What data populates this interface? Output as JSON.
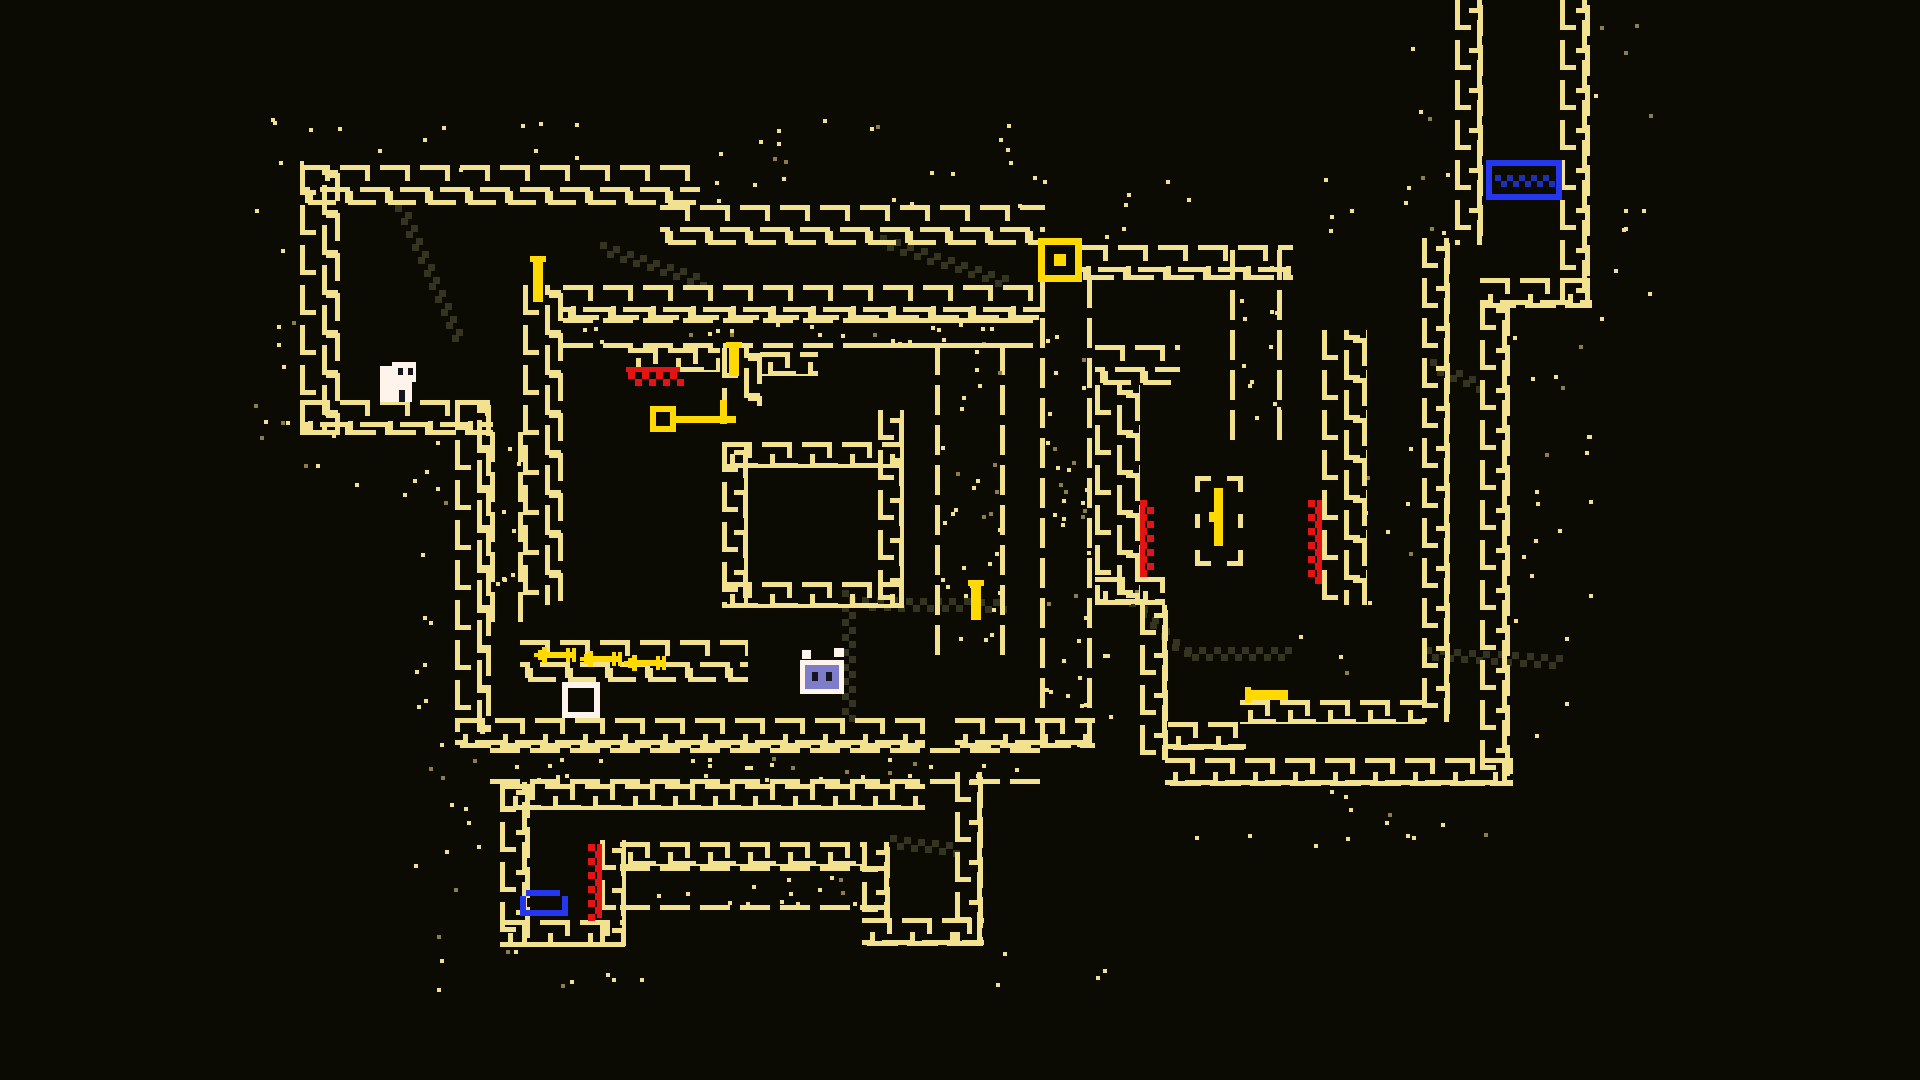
{
  "scene": {
    "width": 1920,
    "height": 1080,
    "bg": "#0b0b03"
  },
  "colors": {
    "wall": "#f2e28f",
    "bright": "#ffd900",
    "red": "#e51414",
    "blue": "#2437ef",
    "bedfill": "#1e2fb8",
    "slime": "#7d7dc9",
    "white": "#fff4ec",
    "dark": "#16161e",
    "trail": "#343420",
    "dim": "#8a7f4a"
  },
  "walls": [
    {
      "x": 300,
      "y": 165,
      "w": 400,
      "h": 40,
      "style": "brick"
    },
    {
      "x": 660,
      "y": 205,
      "w": 385,
      "h": 40,
      "style": "brick"
    },
    {
      "x": 1078,
      "y": 245,
      "w": 215,
      "h": 35,
      "style": "brick"
    },
    {
      "x": 300,
      "y": 165,
      "w": 40,
      "h": 270,
      "style": "brick"
    },
    {
      "x": 300,
      "y": 400,
      "w": 193,
      "h": 35,
      "style": "brick"
    },
    {
      "x": 455,
      "y": 400,
      "w": 36,
      "h": 332,
      "style": "brick"
    },
    {
      "x": 490,
      "y": 432,
      "w": 33,
      "h": 173,
      "style": "dots"
    },
    {
      "x": 523,
      "y": 285,
      "w": 40,
      "h": 320,
      "style": "brick"
    },
    {
      "x": 563,
      "y": 285,
      "w": 482,
      "h": 35,
      "style": "brick"
    },
    {
      "x": 563,
      "y": 318,
      "w": 445,
      "h": 30,
      "style": "dots"
    },
    {
      "x": 628,
      "y": 348,
      "w": 92,
      "h": 24,
      "style": "brick"
    },
    {
      "x": 722,
      "y": 348,
      "w": 40,
      "h": 58,
      "style": "brick"
    },
    {
      "x": 760,
      "y": 352,
      "w": 58,
      "h": 24,
      "style": "brick"
    },
    {
      "x": 722,
      "y": 442,
      "w": 182,
      "h": 26,
      "style": "brick"
    },
    {
      "x": 722,
      "y": 442,
      "w": 26,
      "h": 166,
      "style": "brick"
    },
    {
      "x": 878,
      "y": 410,
      "w": 26,
      "h": 198,
      "style": "brick"
    },
    {
      "x": 722,
      "y": 582,
      "w": 182,
      "h": 26,
      "style": "brick"
    },
    {
      "x": 935,
      "y": 345,
      "w": 70,
      "h": 300,
      "style": "dots"
    },
    {
      "x": 860,
      "y": 318,
      "w": 148,
      "h": 30,
      "style": "dots"
    },
    {
      "x": 1040,
      "y": 278,
      "w": 52,
      "h": 442,
      "style": "dots"
    },
    {
      "x": 455,
      "y": 718,
      "w": 470,
      "h": 30,
      "style": "brick"
    },
    {
      "x": 955,
      "y": 718,
      "w": 140,
      "h": 30,
      "style": "brick"
    },
    {
      "x": 490,
      "y": 748,
      "w": 555,
      "h": 36,
      "style": "dots"
    },
    {
      "x": 505,
      "y": 784,
      "w": 420,
      "h": 26,
      "style": "brick"
    },
    {
      "x": 520,
      "y": 640,
      "w": 228,
      "h": 42,
      "style": "brick"
    },
    {
      "x": 500,
      "y": 782,
      "w": 30,
      "h": 165,
      "style": "brick"
    },
    {
      "x": 500,
      "y": 920,
      "w": 125,
      "h": 27,
      "style": "brick"
    },
    {
      "x": 600,
      "y": 840,
      "w": 26,
      "h": 106,
      "style": "brick"
    },
    {
      "x": 620,
      "y": 842,
      "w": 244,
      "h": 24,
      "style": "brick"
    },
    {
      "x": 620,
      "y": 866,
      "w": 244,
      "h": 44,
      "style": "dots"
    },
    {
      "x": 862,
      "y": 842,
      "w": 28,
      "h": 78,
      "style": "brick"
    },
    {
      "x": 862,
      "y": 918,
      "w": 122,
      "h": 28,
      "style": "brick"
    },
    {
      "x": 955,
      "y": 772,
      "w": 28,
      "h": 174,
      "style": "brick"
    },
    {
      "x": 1095,
      "y": 345,
      "w": 85,
      "h": 40,
      "style": "brick"
    },
    {
      "x": 1230,
      "y": 250,
      "w": 52,
      "h": 172,
      "style": "dots"
    },
    {
      "x": 1095,
      "y": 385,
      "w": 45,
      "h": 220,
      "style": "brick"
    },
    {
      "x": 1322,
      "y": 330,
      "w": 45,
      "h": 275,
      "style": "brick"
    },
    {
      "x": 1095,
      "y": 577,
      "w": 70,
      "h": 28,
      "style": "brick"
    },
    {
      "x": 1140,
      "y": 605,
      "w": 28,
      "h": 155,
      "style": "brick"
    },
    {
      "x": 1168,
      "y": 722,
      "w": 78,
      "h": 28,
      "style": "brick"
    },
    {
      "x": 1240,
      "y": 700,
      "w": 185,
      "h": 24,
      "style": "brick"
    },
    {
      "x": 1165,
      "y": 758,
      "w": 348,
      "h": 28,
      "style": "brick"
    },
    {
      "x": 1422,
      "y": 238,
      "w": 28,
      "h": 484,
      "style": "brick"
    },
    {
      "x": 1455,
      "y": 0,
      "w": 28,
      "h": 245,
      "style": "brick"
    },
    {
      "x": 1560,
      "y": 0,
      "w": 30,
      "h": 305,
      "style": "brick"
    },
    {
      "x": 1480,
      "y": 278,
      "w": 112,
      "h": 30,
      "style": "brick"
    },
    {
      "x": 1480,
      "y": 300,
      "w": 30,
      "h": 486,
      "style": "brick"
    }
  ],
  "dotfields": [
    [
      240,
      118,
      830,
      55
    ],
    [
      242,
      182,
      62,
      255
    ],
    [
      240,
      432,
      225,
      55
    ],
    [
      398,
      455,
      60,
      270
    ],
    [
      412,
      742,
      92,
      215
    ],
    [
      432,
      942,
      250,
      55
    ],
    [
      988,
      942,
      120,
      50
    ],
    [
      1062,
      172,
      125,
      75
    ],
    [
      1300,
      172,
      135,
      68
    ],
    [
      1592,
      2,
      58,
      315
    ],
    [
      1408,
      0,
      50,
      240
    ],
    [
      1512,
      308,
      85,
      95
    ],
    [
      1348,
      438,
      72,
      165
    ],
    [
      1512,
      432,
      78,
      325
    ],
    [
      1168,
      790,
      348,
      58
    ],
    [
      1062,
      580,
      80,
      165
    ],
    [
      700,
      162,
      355,
      45
    ],
    [
      1288,
      610,
      58,
      95
    ]
  ],
  "trails": [
    [
      398,
      205,
      455,
      335
    ],
    [
      600,
      245,
      700,
      278
    ],
    [
      880,
      238,
      1002,
      278
    ],
    [
      845,
      590,
      845,
      715
    ],
    [
      862,
      600,
      1000,
      602
    ],
    [
      890,
      838,
      953,
      846
    ],
    [
      1132,
      600,
      1180,
      650
    ],
    [
      1185,
      650,
      1285,
      650
    ],
    [
      1425,
      650,
      1556,
      658
    ],
    [
      1430,
      362,
      1476,
      382
    ]
  ],
  "spikes": [
    {
      "x": 588,
      "y": 844,
      "len": 74,
      "dir": "v",
      "side": "right"
    },
    {
      "x": 1140,
      "y": 500,
      "len": 77,
      "dir": "v",
      "side": "left"
    },
    {
      "x": 1308,
      "y": 500,
      "len": 84,
      "dir": "v",
      "side": "right"
    },
    {
      "x": 628,
      "y": 372,
      "len": 50,
      "dir": "h",
      "side": "top"
    }
  ],
  "arrows": [
    [
      534,
      646
    ],
    [
      580,
      650
    ],
    [
      624,
      654
    ]
  ],
  "levers": [
    {
      "x": 533,
      "y": 256,
      "w": 10,
      "h": 46,
      "dir": "v"
    },
    {
      "x": 729,
      "y": 342,
      "w": 10,
      "h": 34,
      "dir": "v"
    },
    {
      "x": 971,
      "y": 580,
      "w": 10,
      "h": 40,
      "dir": "v"
    },
    {
      "x": 1248,
      "y": 690,
      "w": 40,
      "h": 10,
      "dir": "h"
    }
  ],
  "entities": {
    "player": {
      "label": "player-character",
      "x": 378,
      "y": 356,
      "w": 42,
      "h": 48
    },
    "key": {
      "label": "key-item",
      "x": 650,
      "y": 400,
      "w": 92,
      "h": 38
    },
    "door": {
      "label": "exit-door",
      "x": 1038,
      "y": 238,
      "w": 46,
      "h": 46
    },
    "bed": {
      "label": "save-bed",
      "x": 1486,
      "y": 160,
      "w": 78,
      "h": 44
    },
    "slime": {
      "label": "slime-enemy",
      "x": 798,
      "y": 648,
      "w": 50,
      "h": 52
    },
    "box": {
      "label": "empty-chest-box",
      "x": 558,
      "y": 678,
      "w": 46,
      "h": 44
    },
    "bowl": {
      "label": "blue-bowl-item",
      "x": 514,
      "y": 886,
      "w": 56,
      "h": 34
    },
    "shrine": {
      "label": "shrine-with-rod",
      "x": 1195,
      "y": 476,
      "w": 52,
      "h": 92
    }
  }
}
